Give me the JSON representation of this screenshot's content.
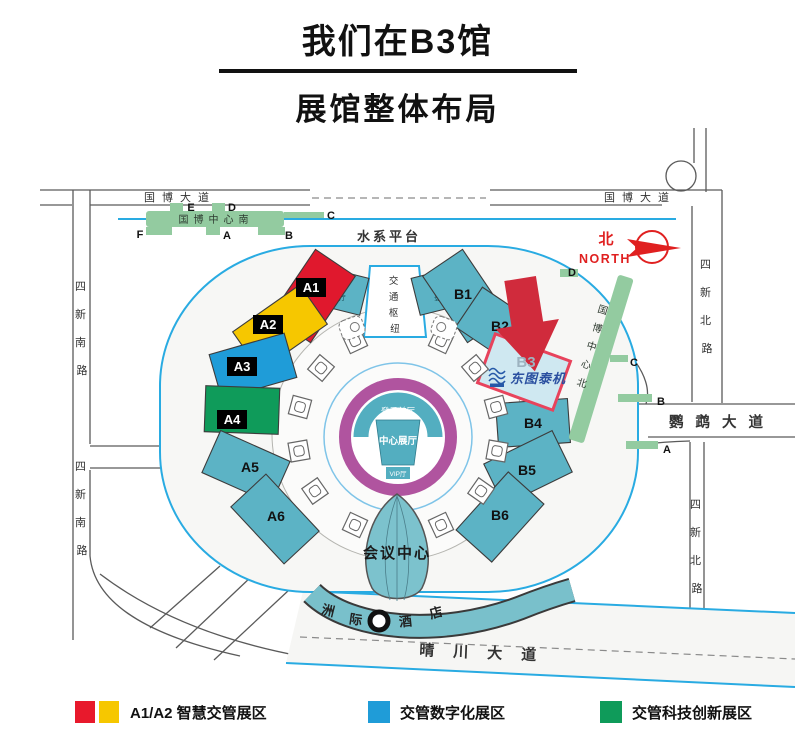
{
  "title": "我们在B3馆",
  "subtitle": "展馆整体布局",
  "legend": [
    {
      "colors": [
        "#e8192c",
        "#f6c700"
      ],
      "label": "A1/A2 智慧交管展区"
    },
    {
      "colors": [
        "#1f9cd8"
      ],
      "label": "交管数字化展区"
    },
    {
      "colors": [
        "#0f9b5a"
      ],
      "label": "交管科技创新展区"
    }
  ],
  "map": {
    "streets": {
      "guobo_avenue": "国博大道",
      "sixin_south": "四新南路",
      "sixin_north": "四新北路",
      "yingwu_avenue": "鹦鹉大道",
      "qingchuan_avenue": "晴川大道"
    },
    "north": {
      "cn": "北",
      "en": "NORTH"
    },
    "metro_south": {
      "name": "国博中心南",
      "exit_e": "E",
      "exit_d": "D",
      "exit_c": "C",
      "exit_f": "F",
      "exit_a": "A",
      "exit_b": "B"
    },
    "metro_north": {
      "name": "国博中心北",
      "exit_d": "D",
      "exit_c": "C",
      "exit_b": "B",
      "exit_a": "A"
    },
    "water_platform": "水系平台",
    "transport_hub": "交通枢纽",
    "halls": {
      "a0": {
        "label": "A0",
        "sub": "登录厅"
      },
      "b0": {
        "label": "B0",
        "sub": "登录厅"
      },
      "a1": {
        "label": "A1",
        "color": "#e0182d"
      },
      "a2": {
        "label": "A2",
        "color": "#f6c700"
      },
      "a3": {
        "label": "A3",
        "color": "#1f9cd8"
      },
      "a4": {
        "label": "A4",
        "color": "#0f9b5a"
      },
      "a5": {
        "label": "A5",
        "color": "#5cb3c5"
      },
      "a6": {
        "label": "A6",
        "color": "#5cb3c5"
      },
      "b1": {
        "label": "B1",
        "color": "#5cb3c5"
      },
      "b2": {
        "label": "B2",
        "color": "#5cb3c5"
      },
      "b3": {
        "label": "B3",
        "color": "#cfe8f1",
        "border": "#e8435c"
      },
      "b4": {
        "label": "B4",
        "color": "#5cb3c5"
      },
      "b5": {
        "label": "B5",
        "color": "#5cb3c5"
      },
      "b6": {
        "label": "B6",
        "color": "#5cb3c5"
      }
    },
    "center": {
      "front_hall": "登录前厅",
      "main_hall": "中心展厅",
      "vip_hall": "VIP厅"
    },
    "conference_center": "会议中心",
    "hotel": "洲际酒店",
    "exhibitor_logo": "东图泰机"
  }
}
